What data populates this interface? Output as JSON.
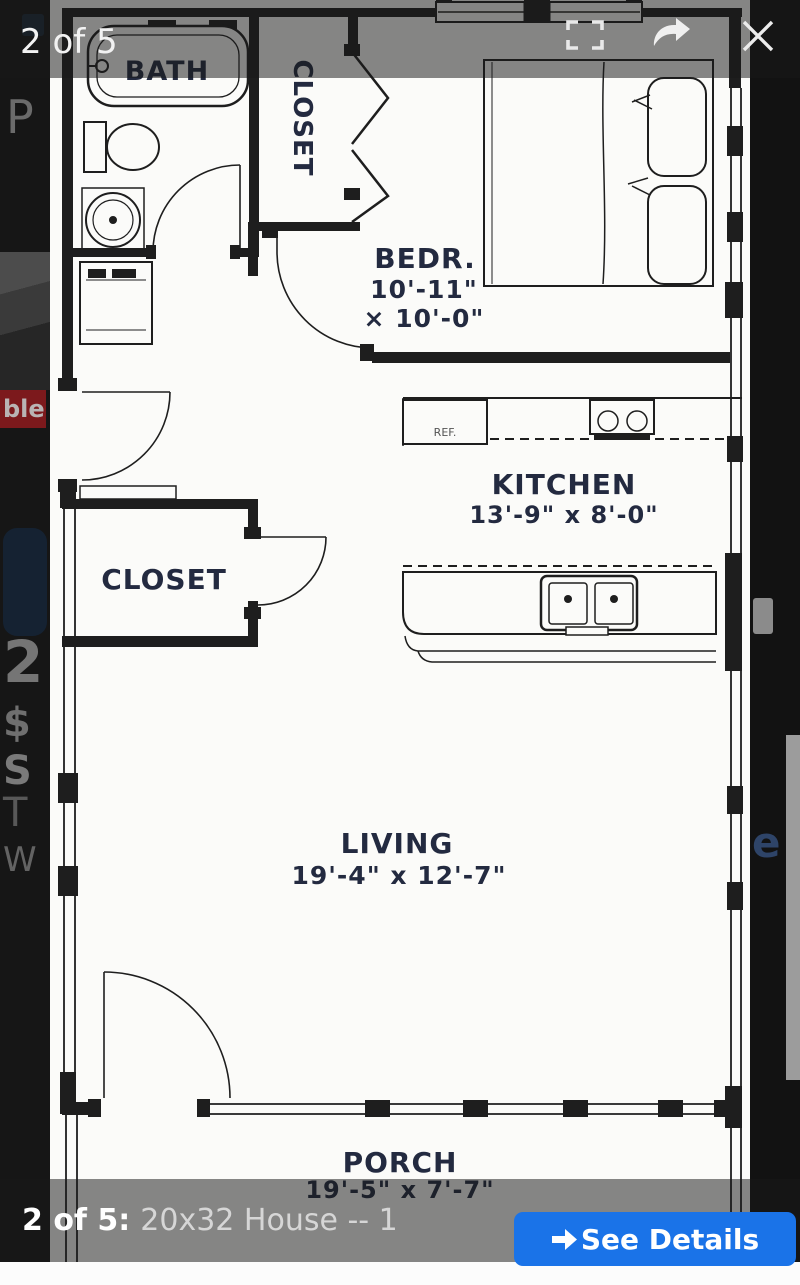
{
  "viewer": {
    "top_counter": "2 of 5",
    "icons": {
      "fullscreen": "corner-brackets",
      "share": "curved-arrow",
      "close": "x-mark"
    }
  },
  "floor_plan": {
    "bath": {
      "label": "BATH"
    },
    "closet_top": {
      "label": "CLOSET"
    },
    "bedroom": {
      "label": "BEDR.",
      "dim1": "10'-11\"",
      "dim2": "× 10'-0\""
    },
    "kitchen": {
      "label": "KITCHEN",
      "dims": "13'-9\" x 8'-0\""
    },
    "closet_mid": {
      "label": "CLOSET"
    },
    "living": {
      "label": "LIVING",
      "dims": "19'-4\" x 12'-7\""
    },
    "porch": {
      "label": "PORCH",
      "dims": "19'-5\" x 7'-7\""
    },
    "fridge_label": "REF."
  },
  "bottom_bar": {
    "counter": "2 of 5:",
    "caption": "20x32 House -- 1",
    "button": {
      "label": "See Details"
    }
  },
  "background_page": {
    "fragments": {
      "p": "P",
      "badge": "ble",
      "num": "2",
      "dollar": "$",
      "s": "S",
      "t": "T",
      "w": "W",
      "e": "e"
    }
  },
  "colors": {
    "accent_blue": "#1a73e8",
    "badge_red": "#7c191c",
    "plan_ink": "#1e1e1e",
    "label_ink": "#232a40"
  }
}
